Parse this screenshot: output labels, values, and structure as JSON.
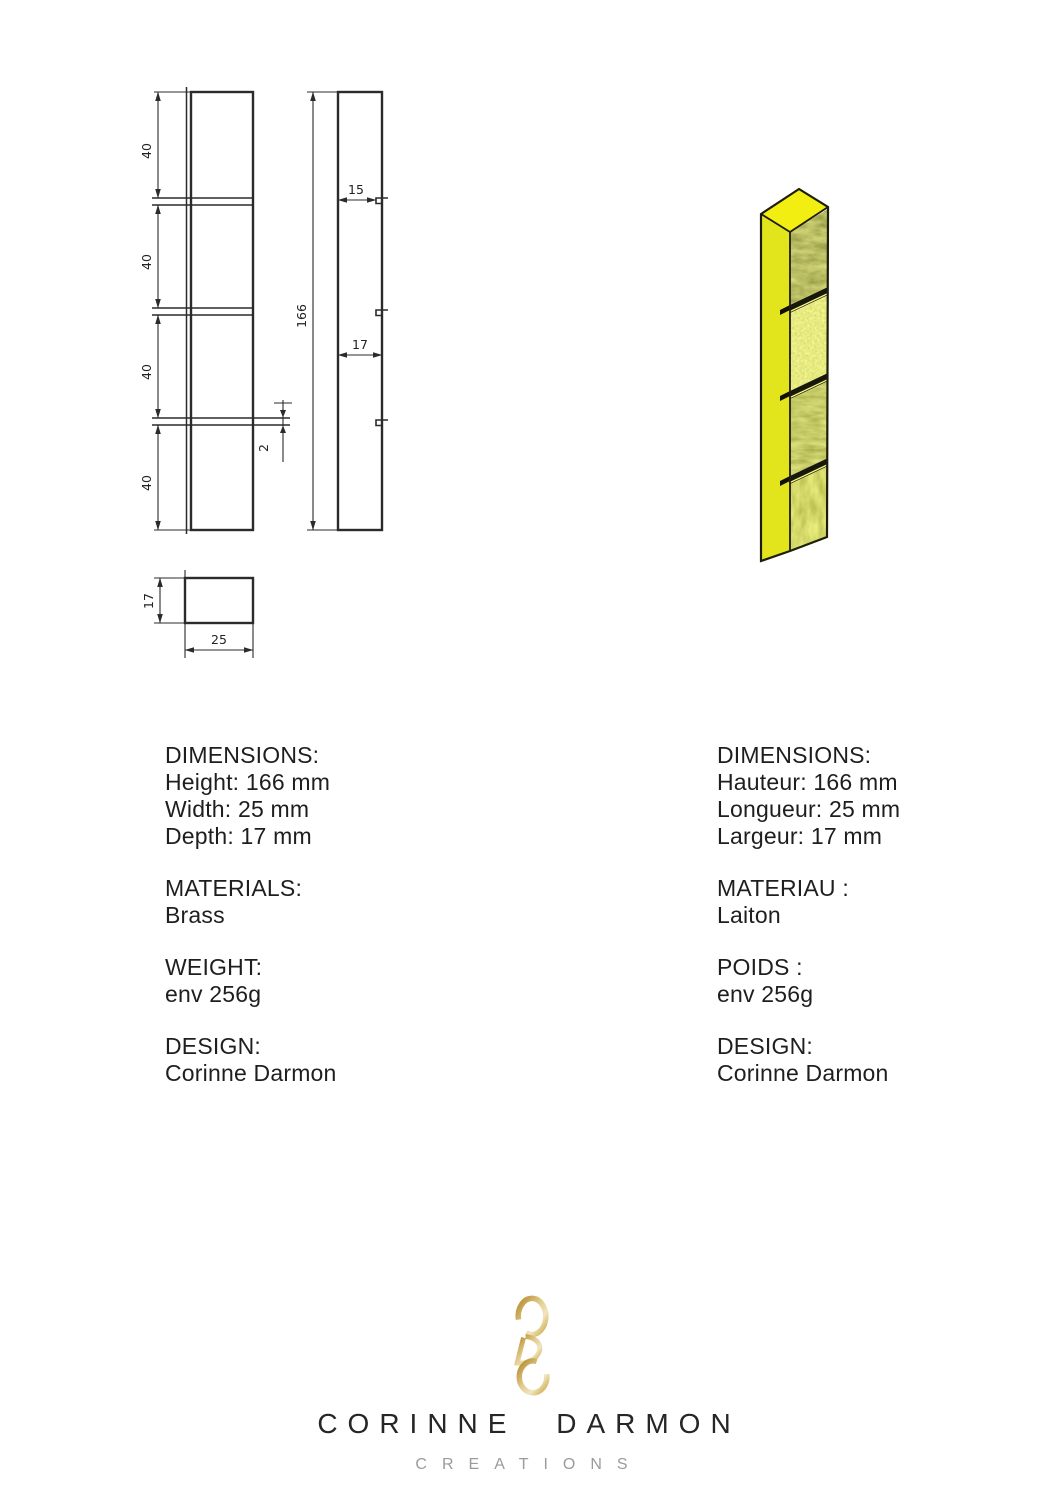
{
  "page": {
    "background": "#ffffff"
  },
  "technical_drawing": {
    "segment_height_dims": [
      "40",
      "40",
      "40",
      "40"
    ],
    "total_height_dim": "166",
    "recess_depth_dim": "15",
    "depth_dim": "17",
    "groove_height_dim": "2",
    "section_depth_dim": "17",
    "section_width_dim": "25"
  },
  "product_render": {
    "top_face_color": "#f2ee12",
    "side_face_color": "#e2e41c",
    "outline_color": "#1d1d0b",
    "groove_color": "#17170a",
    "texture_base_colors": [
      "#6e7012",
      "#dde24f",
      "#98a02b",
      "#aeb631"
    ]
  },
  "specs_en": {
    "groups": [
      {
        "title": "DIMENSIONS:",
        "lines": [
          "Height: 166 mm",
          "Width: 25 mm",
          "Depth: 17 mm"
        ]
      },
      {
        "title": "MATERIALS:",
        "lines": [
          "Brass"
        ]
      },
      {
        "title": "WEIGHT:",
        "lines": [
          "env 256g"
        ]
      },
      {
        "title": "DESIGN:",
        "lines": [
          "Corinne Darmon"
        ]
      }
    ]
  },
  "specs_fr": {
    "groups": [
      {
        "title": "DIMENSIONS:",
        "lines": [
          "Hauteur: 166 mm",
          "Longueur: 25 mm",
          "Largeur: 17 mm"
        ]
      },
      {
        "title": "MATERIAU :",
        "lines": [
          "Laiton"
        ]
      },
      {
        "title": "POIDS :",
        "lines": [
          "env 256g"
        ]
      },
      {
        "title": "DESIGN:",
        "lines": [
          "Corinne Darmon"
        ]
      }
    ]
  },
  "logo": {
    "monogram_letters": [
      "C",
      "D",
      "C"
    ],
    "gold_dark": "#b3892a",
    "gold_light": "#f0e6c0",
    "brand_name": "CORINNE DARMON",
    "brand_subtitle": "CREATIONS"
  }
}
